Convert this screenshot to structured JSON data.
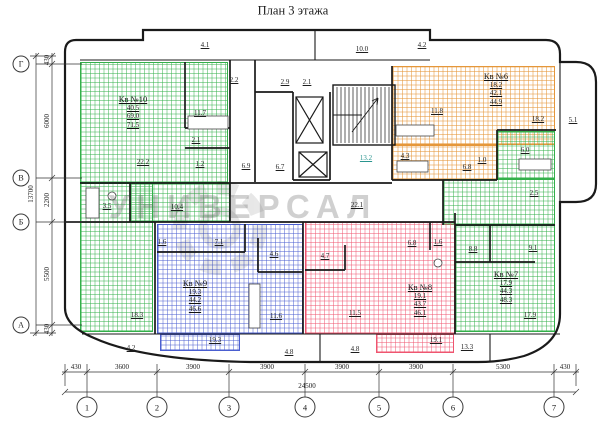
{
  "title": "План 3 этажа",
  "watermark": "УНИВЕРСАЛ",
  "axes": {
    "rows": [
      "Г",
      "В",
      "Б",
      "А"
    ],
    "cols": [
      "1",
      "2",
      "3",
      "4",
      "5",
      "6",
      "7"
    ]
  },
  "dimensions": {
    "left": {
      "total": "13700",
      "segments": [
        "430",
        "6000",
        "2200",
        "5500",
        "430"
      ]
    },
    "bottom": {
      "total": "24500",
      "segments": [
        "430",
        "3600",
        "3900",
        "3900",
        "3900",
        "3900",
        "5300",
        "430"
      ]
    }
  },
  "apartments": [
    {
      "label": "Кв №10",
      "living": "40.5",
      "total": "69.0",
      "with_balcony": "71.5",
      "color": "#33b04a"
    },
    {
      "label": "Кв №6",
      "living": "18.2",
      "total": "42.1",
      "with_balcony": "44.9",
      "color": "#e5973a"
    },
    {
      "label": "Кв №9",
      "living": "19.3",
      "total": "44.2",
      "with_balcony": "46.6",
      "color": "#4a5ed0"
    },
    {
      "label": "Кв №8",
      "living": "19.1",
      "total": "43.7",
      "with_balcony": "46.1",
      "color": "#ef5570"
    },
    {
      "label": "Кв №7",
      "living": "17.9",
      "total": "44.3",
      "with_balcony": "48.3",
      "color": "#33b04a"
    }
  ],
  "rooms": {
    "balcony_top_left": "4.1",
    "roof_top_mid": "10.0",
    "balcony_top_right": "4.2",
    "tambour": "2.2",
    "vestibule": "2.9",
    "lift_hall": "2.1",
    "kv10_kitchen": "11.7",
    "kv10_hall": "2.1",
    "kv10_room1": "22.2",
    "kv10_wc": "1.2",
    "corridor_left": "6.9",
    "lift_shaft": "6.7",
    "stairs": "13.2",
    "kv10_bath": "3.5",
    "kv10_hall2": "10.4",
    "kv6_bath": "4.3",
    "kv6_kitchen": "11.8",
    "kv6_room": "18.2",
    "kv6_hall": "6.8",
    "kv6_wc": "1.0",
    "balcony_right": "5.1",
    "kv7_bath": "6.0",
    "kv7_hall": "2.5",
    "kv7_room2": "8.8",
    "kv7_corridor": "9.1",
    "kv7_room1": "17.9",
    "corridor_main": "22.1",
    "kv9_wc": "1.6",
    "kv9_hall": "7.1",
    "kv9_bath": "4.6",
    "kv9_kitchen": "11.6",
    "kv9_room1": "19.3",
    "kv8_hall": "6.8",
    "kv8_wc": "1.6",
    "kv8_bath": "4.7",
    "kv8_kitchen": "11.5",
    "kv8_room1": "19.1",
    "kv10_room2": "18.3",
    "balcony_bottom_left": "4.2",
    "balcony_bottom_1": "4.8",
    "balcony_bottom_2": "4.8",
    "balcony_bottom_right": "13.3"
  }
}
